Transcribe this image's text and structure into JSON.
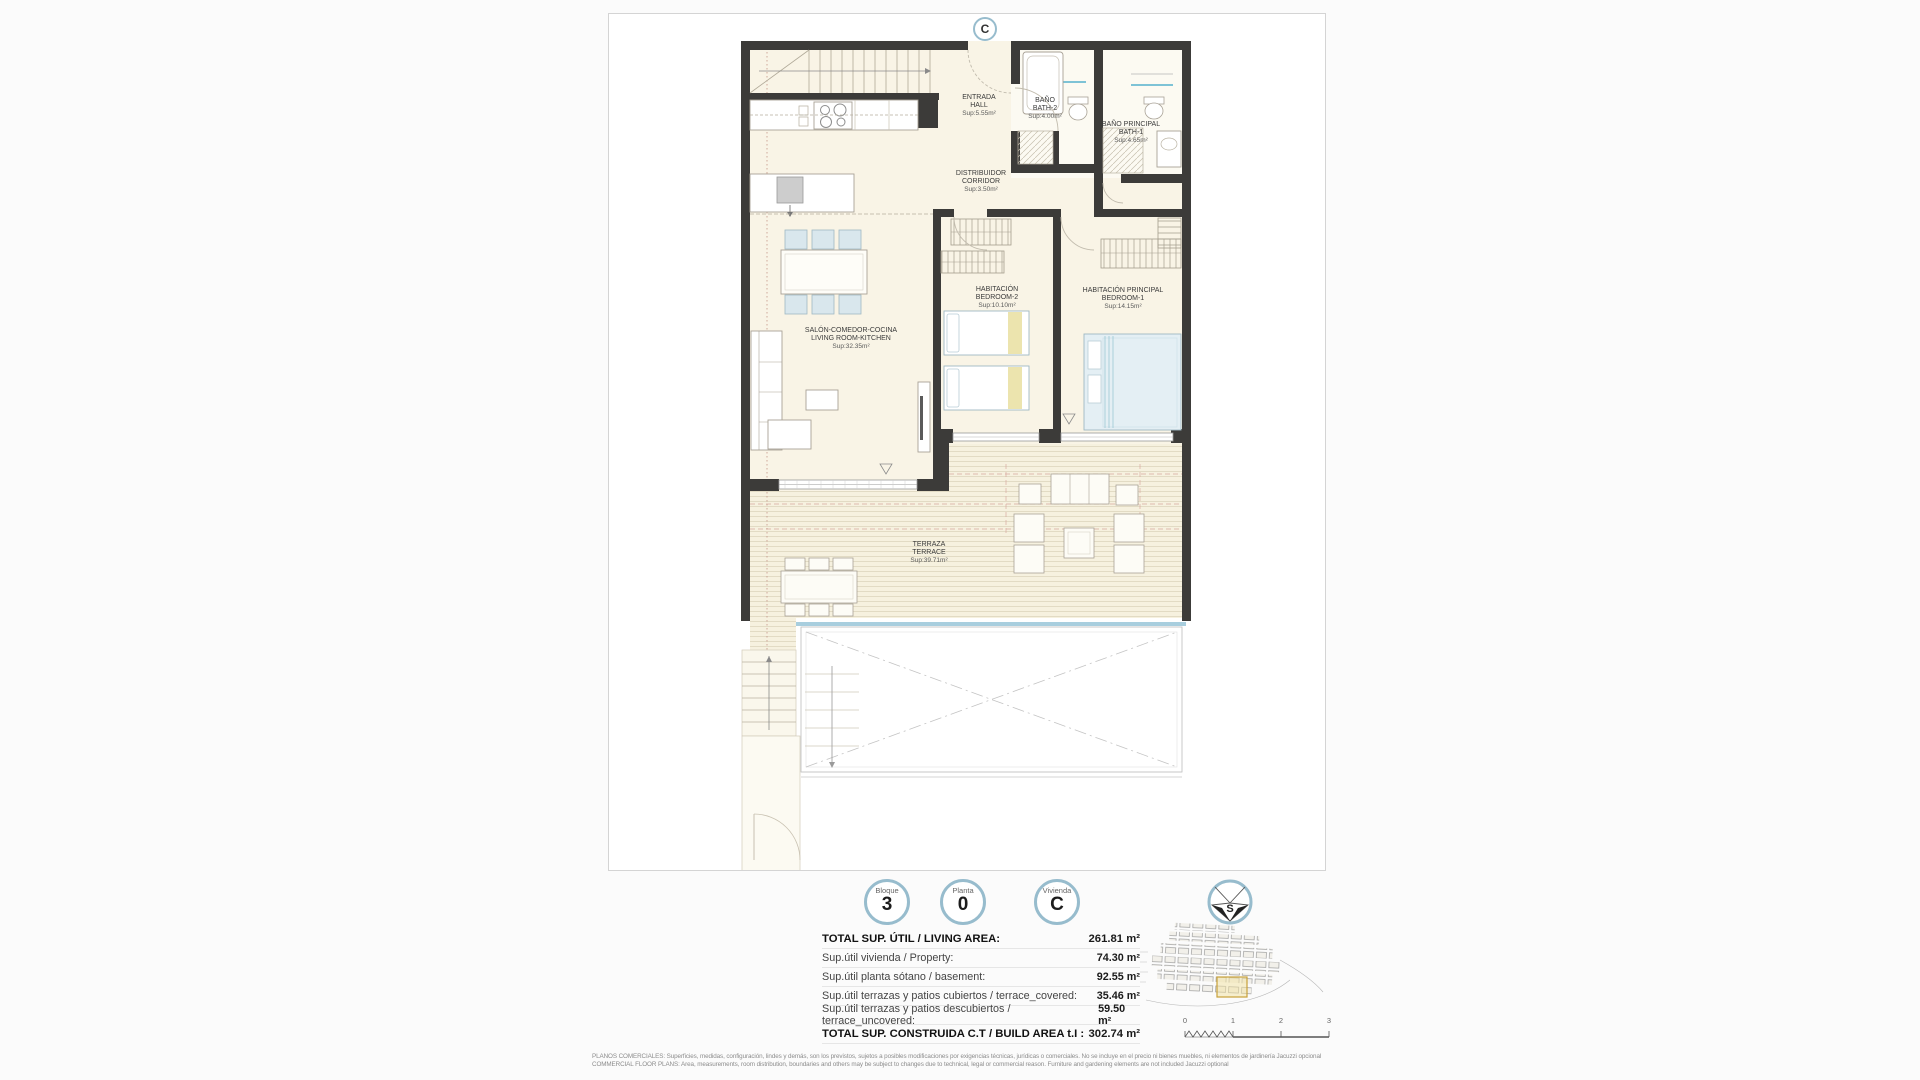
{
  "plan": {
    "unit_badge": "C",
    "rooms": [
      {
        "name_es": "ENTRADA",
        "name_en": "HALL",
        "sup": "Sup:5.55m²"
      },
      {
        "name_es": "BAÑO",
        "name_en": "BATH-2",
        "sup": "Sup:4.00m²"
      },
      {
        "name_es": "BAÑO PRINCIPAL",
        "name_en": "BATH-1",
        "sup": "Sup:4.65m²"
      },
      {
        "name_es": "DISTRIBUIDOR",
        "name_en": "CORRIDOR",
        "sup": "Sup:3.50m²"
      },
      {
        "name_es": "SALÓN-COMEDOR-COCINA",
        "name_en": "LIVING ROOM-KITCHEN",
        "sup": "Sup:32.35m²"
      },
      {
        "name_es": "HABITACIÓN",
        "name_en": "BEDROOM-2",
        "sup": "Sup:10.10m²"
      },
      {
        "name_es": "HABITACIÓN PRINCIPAL",
        "name_en": "BEDROOM-1",
        "sup": "Sup:14.15m²"
      },
      {
        "name_es": "TERRAZA",
        "name_en": "TERRACE",
        "sup": "Sup:39.71m²"
      }
    ]
  },
  "badges": [
    {
      "label": "Bloque",
      "value": "3"
    },
    {
      "label": "Planta",
      "value": "0"
    },
    {
      "label": "Vivienda",
      "value": "C"
    }
  ],
  "compass": {
    "label": "S"
  },
  "area_table": {
    "rows": [
      {
        "label": "TOTAL SUP. ÚTIL / LIVING AREA:",
        "value": "261.81 m²"
      },
      {
        "label": "Sup.útil vivienda / Property:",
        "value": "74.30 m²"
      },
      {
        "label": "Sup.útil planta sótano / basement:",
        "value": "92.55 m²"
      },
      {
        "label": "Sup.útil terrazas y patios cubiertos / terrace_covered:",
        "value": "35.46 m²"
      },
      {
        "label": "Sup.útil terrazas y patios descubiertos / terrace_uncovered:",
        "value": "59.50 m²"
      },
      {
        "label": "TOTAL SUP. CONSTRUIDA C.T / BUILD AREA t.I :",
        "value": "302.74 m²"
      }
    ]
  },
  "scale_bar": {
    "ticks": [
      "0",
      "1",
      "2",
      "3"
    ]
  },
  "disclaimer": {
    "line_es": "PLANOS COMERCIALES: Superficies, medidas, configuración, lindes y demás, son los previstos, sujetos a posibles modificaciones por exigencias técnicas, jurídicas o comerciales. No se incluye en el precio ni bienes muebles, ni elementos de jardinería Jacuzzi opcional",
    "line_en": "COMMERCIAL FLOOR PLANS: Area, measurements, room distribution, boundaries and others may be subject to changes due to technical, legal or commercial reason. Furniture and gardening elements are not included Jacuzzi optional"
  },
  "colors": {
    "accent_ring": "#97bccd",
    "wall": "#3c3b39",
    "floor": "#f9f4e6",
    "pool_edge": "#a8cede",
    "highlight": "#c8a13a"
  }
}
